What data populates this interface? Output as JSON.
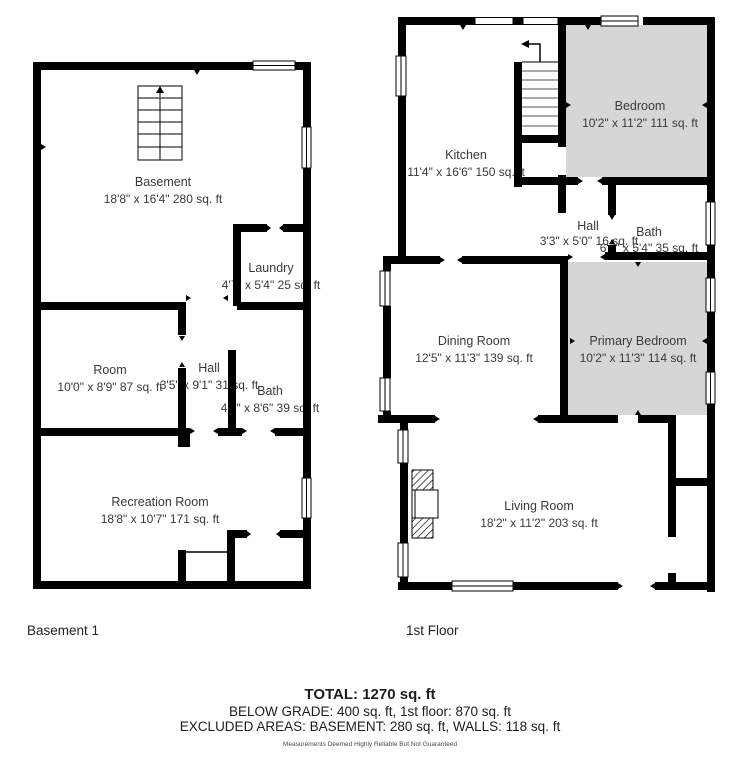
{
  "colors": {
    "wall": "#000000",
    "bedroom_fill": "#d6d6d6",
    "room_text": "#3a3a3a",
    "disclaimer_text": "#4a4a4a"
  },
  "plans": {
    "basement": {
      "label": "Basement 1",
      "rooms": {
        "basement": {
          "name": "Basement",
          "dims": "18'8\" x 16'4\" 280 sq. ft"
        },
        "laundry": {
          "name": "Laundry",
          "dims": "4'7\" x 5'4\" 25 sq. ft"
        },
        "room": {
          "name": "Room",
          "dims": "10'0\" x 8'9\" 87 sq. ft"
        },
        "hall": {
          "name": "Hall",
          "dims": "3'5\" x 9'1\" 31 sq. ft"
        },
        "bath": {
          "name": "Bath",
          "dims": "4'7\" x 8'6\" 39 sq. ft"
        },
        "recreation": {
          "name": "Recreation Room",
          "dims": "18'8\" x 10'7\" 171 sq. ft"
        }
      }
    },
    "first_floor": {
      "label": "1st Floor",
      "rooms": {
        "kitchen": {
          "name": "Kitchen",
          "dims": "11'4\" x 16'6\" 150 sq. ft"
        },
        "bedroom": {
          "name": "Bedroom",
          "dims": "10'2\" x 11'2\" 111 sq. ft"
        },
        "hall": {
          "name": "Hall",
          "dims": "3'3\" x 5'0\" 16 sq. ft"
        },
        "bath": {
          "name": "Bath",
          "dims": "6'7\" x 5'4\" 35 sq. ft"
        },
        "dining": {
          "name": "Dining Room",
          "dims": "12'5\" x 11'3\" 139 sq. ft"
        },
        "primary": {
          "name": "Primary Bedroom",
          "dims": "10'2\" x 11'3\" 114 sq. ft"
        },
        "living": {
          "name": "Living Room",
          "dims": "18'2\" x 11'2\" 203 sq. ft"
        }
      }
    }
  },
  "summary": {
    "total": "TOTAL: 1270 sq. ft",
    "line2": "BELOW GRADE: 400 sq. ft, 1st floor: 870 sq. ft",
    "line3": "EXCLUDED AREAS: BASEMENT: 280 sq. ft, WALLS: 118 sq. ft",
    "disclaimer": "Measurements Deemed Highly Reliable But Not Guaranteed"
  }
}
